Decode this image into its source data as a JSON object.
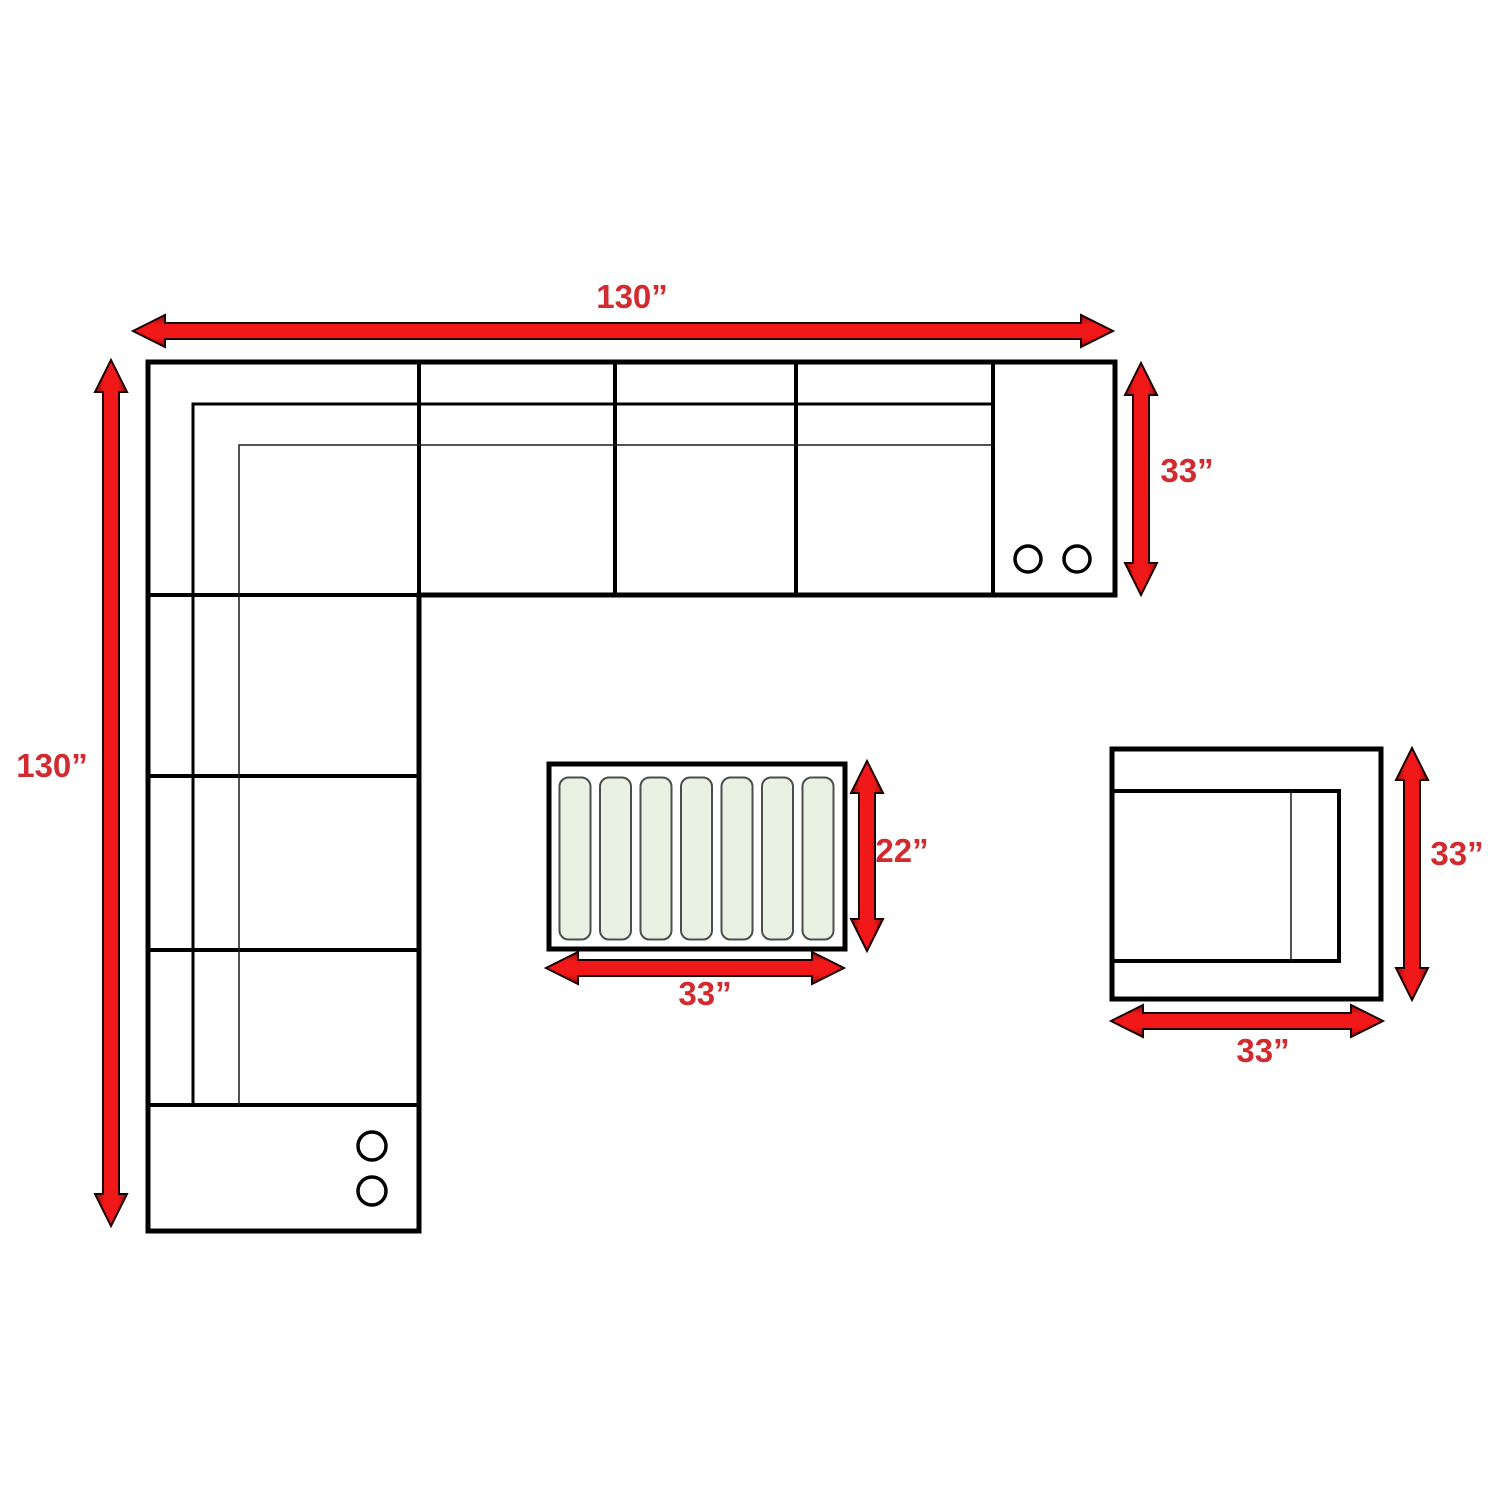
{
  "diagram": {
    "type": "sectional-sofa-dimension-plan",
    "pieces": {
      "sectional": {
        "name": "L-shaped sectional sofa (top view)",
        "width": "130”",
        "depth_total": "130”",
        "section_depth": "33”",
        "cupholders_right_console": 2,
        "cupholders_bottom_console": 2
      },
      "ottoman": {
        "name": "slatted ottoman table (top view)",
        "width": "33”",
        "depth": "22”",
        "slat_count": 7
      },
      "armchair": {
        "name": "armless chair (top view)",
        "width": "33”",
        "depth": "33”"
      }
    },
    "colors": {
      "arrow_red": "#ec1c24",
      "arrow_dark_red": "#8f0d0d",
      "label_red": "#d22b2f",
      "line_black": "#000000",
      "slat_green_fill": "#e9f1e3",
      "slat_gray_border": "#4d4d4d",
      "background": "#ffffff"
    }
  }
}
